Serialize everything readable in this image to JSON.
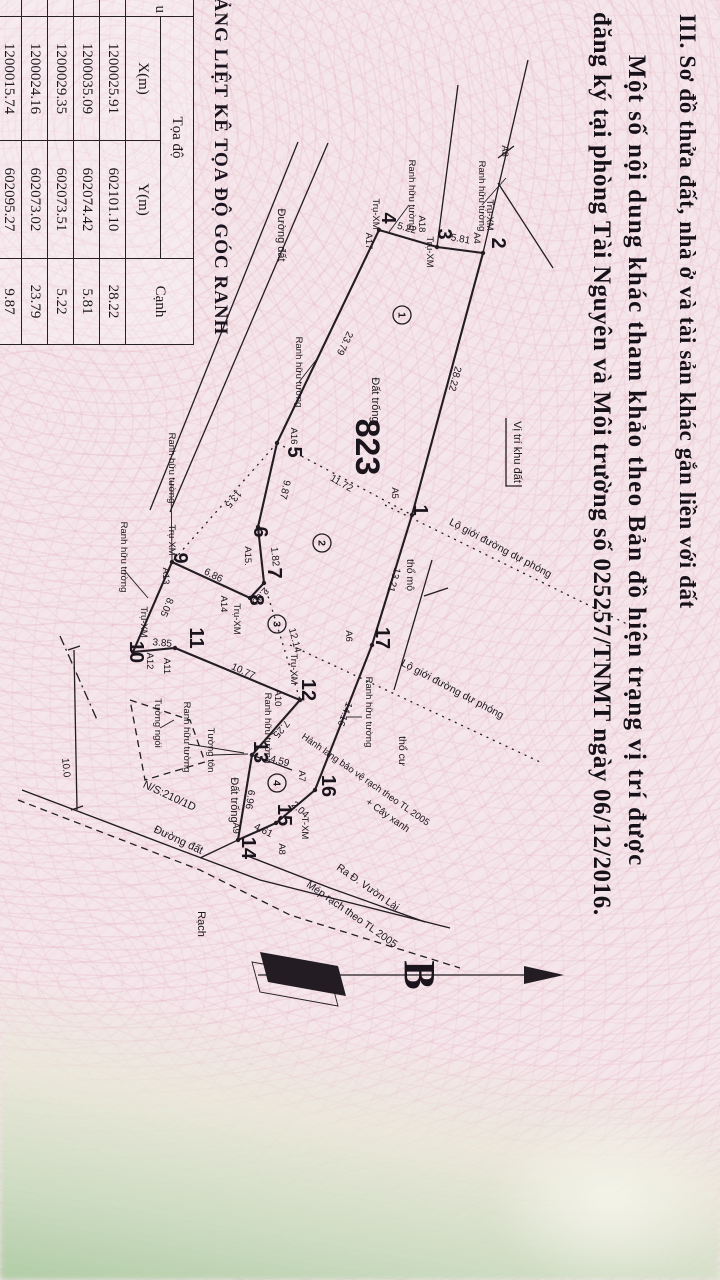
{
  "heading": {
    "line1": "III. Sơ đồ thửa đất, nhà ở và tài sản khác gắn liền với đất",
    "line2": "Một số nội dung khác tham khảo theo Bản đồ hiện trạng vị trí được",
    "line3": "đăng ký tại phòng Tài Nguyên và Môi trường số 025257/TNMT ngày 06/12/2016."
  },
  "compass": {
    "label": "B"
  },
  "table": {
    "title": "BẢNG LIỆT KÊ TỌA ĐỘ GÓC RANH",
    "col_fragment": "u",
    "group_header": "Tọa độ",
    "col_x": "X(m)",
    "col_y": "Y(m)",
    "col_edge": "Cạnh",
    "rows": [
      [
        "1200025.91",
        "602101.10",
        "28.22"
      ],
      [
        "1200035.09",
        "602074.42",
        "5.81"
      ],
      [
        "1200029.35",
        "602073.51",
        "5.22"
      ],
      [
        "1200024.16",
        "602073.02",
        "23.79"
      ],
      [
        "1200015.74",
        "602095.27",
        "9.87"
      ]
    ]
  },
  "map": {
    "plot_number": "823",
    "points": [
      {
        "t": "1",
        "x": 510,
        "y": 306
      },
      {
        "t": "2",
        "x": 243,
        "y": 228
      },
      {
        "t": "3",
        "x": 234,
        "y": 282
      },
      {
        "t": "4",
        "x": 218,
        "y": 338
      },
      {
        "t": "5",
        "x": 452,
        "y": 432
      },
      {
        "t": "6",
        "x": 532,
        "y": 466
      },
      {
        "t": "7",
        "x": 573,
        "y": 452
      },
      {
        "t": "8",
        "x": 600,
        "y": 470
      },
      {
        "t": "9",
        "x": 558,
        "y": 546
      },
      {
        "t": "10",
        "x": 652,
        "y": 590
      },
      {
        "t": "11",
        "x": 638,
        "y": 530
      },
      {
        "t": "12",
        "x": 690,
        "y": 418
      },
      {
        "t": "13",
        "x": 752,
        "y": 466
      },
      {
        "t": "14",
        "x": 848,
        "y": 478
      },
      {
        "t": "15",
        "x": 815,
        "y": 442
      },
      {
        "t": "16",
        "x": 786,
        "y": 398
      },
      {
        "t": "17",
        "x": 638,
        "y": 344
      }
    ],
    "markers": [
      {
        "t": "A3",
        "x": 151,
        "y": 218
      },
      {
        "t": "Trụ-XM",
        "x": 215,
        "y": 233
      },
      {
        "t": "A4",
        "x": 238,
        "y": 246
      },
      {
        "t": "A18",
        "x": 224,
        "y": 301
      },
      {
        "t": "Trụ-XM",
        "x": 252,
        "y": 293
      },
      {
        "t": "Trụ-XM",
        "x": 214,
        "y": 347
      },
      {
        "t": "A17",
        "x": 241,
        "y": 354
      },
      {
        "t": "A16",
        "x": 436,
        "y": 429
      },
      {
        "t": "A5",
        "x": 493,
        "y": 328
      },
      {
        "t": "A6",
        "x": 636,
        "y": 374
      },
      {
        "t": "A15.",
        "x": 556,
        "y": 475
      },
      {
        "t": "Trụ-XM",
        "x": 619,
        "y": 486
      },
      {
        "t": "A14",
        "x": 604,
        "y": 499
      },
      {
        "t": "A13",
        "x": 576,
        "y": 557
      },
      {
        "t": "Trụ-XM",
        "x": 540,
        "y": 551
      },
      {
        "t": "Trụ-XM",
        "x": 622,
        "y": 579
      },
      {
        "t": "A12",
        "x": 661,
        "y": 573
      },
      {
        "t": "A11",
        "x": 666,
        "y": 556
      },
      {
        "t": "A10",
        "x": 698,
        "y": 445
      },
      {
        "t": "Trụ-XM",
        "x": 669,
        "y": 429
      },
      {
        "t": "A9",
        "x": 828,
        "y": 487
      },
      {
        "t": "A8",
        "x": 849,
        "y": 441
      },
      {
        "t": "T-XM",
        "x": 828,
        "y": 418
      },
      {
        "t": "A7",
        "x": 776,
        "y": 421
      }
    ],
    "dimensions": [
      {
        "t": "28.22",
        "x": 378,
        "y": 268,
        "a": 15
      },
      {
        "t": "5.81",
        "x": 242,
        "y": 260,
        "a": -80
      },
      {
        "t": "5.22",
        "x": 231,
        "y": 314,
        "a": -74
      },
      {
        "t": "23.79",
        "x": 342,
        "y": 378,
        "a": 26
      },
      {
        "t": "11.72",
        "x": 486,
        "y": 380,
        "a": -60
      },
      {
        "t": "13.5",
        "x": 497,
        "y": 489,
        "a": 41
      },
      {
        "t": "9.87",
        "x": 489,
        "y": 438,
        "a": 13
      },
      {
        "t": "1.82",
        "x": 557,
        "y": 448,
        "a": -6
      },
      {
        "t": "2.00",
        "x": 594,
        "y": 462,
        "a": 43
      },
      {
        "t": "6.86",
        "x": 578,
        "y": 508,
        "a": -63
      },
      {
        "t": "8.05",
        "x": 606,
        "y": 556,
        "a": 23
      },
      {
        "t": "3.85",
        "x": 646,
        "y": 558,
        "a": -85
      },
      {
        "t": "10.77",
        "x": 674,
        "y": 478,
        "a": -65
      },
      {
        "t": "7.25",
        "x": 727,
        "y": 441,
        "a": 41
      },
      {
        "t": "12.14",
        "x": 641,
        "y": 428,
        "a": -15
      },
      {
        "t": "4.59",
        "x": 764,
        "y": 441,
        "a": -75
      },
      {
        "t": "6.96",
        "x": 799,
        "y": 473,
        "a": 9
      },
      {
        "t": "4.61",
        "x": 833,
        "y": 458,
        "a": -63
      },
      {
        "t": "2.04",
        "x": 812,
        "y": 422,
        "a": -48
      },
      {
        "t": "14.16",
        "x": 713,
        "y": 378,
        "a": 21
      },
      {
        "t": "13.21",
        "x": 579,
        "y": 329,
        "a": 17
      }
    ],
    "labels": [
      {
        "t": "823",
        "x": 447,
        "y": 364,
        "a": 0,
        "s": 34,
        "b": 1,
        "n": "plot-number-label"
      },
      {
        "t": "Đất trống",
        "x": 400,
        "y": 348,
        "a": 0,
        "s": 11
      },
      {
        "t": "Đất trống",
        "x": 800,
        "y": 489,
        "a": 0,
        "s": 11
      },
      {
        "t": "Vị trí khu đất",
        "x": 452,
        "y": 206,
        "a": 0,
        "s": 11
      },
      {
        "t": "Ranh hữu tường",
        "x": 195,
        "y": 311,
        "a": 0,
        "s": 9.5
      },
      {
        "t": "Ranh hữu tường",
        "x": 196,
        "y": 241,
        "a": 0,
        "s": 9.5
      },
      {
        "t": "Ranh hữu tường",
        "x": 372,
        "y": 424,
        "a": 0,
        "s": 9.5
      },
      {
        "t": "Ranh hữu tường",
        "x": 468,
        "y": 551,
        "a": 0,
        "s": 9.5
      },
      {
        "t": "Ranh hữu tường",
        "x": 557,
        "y": 599,
        "a": 0,
        "s": 9.5
      },
      {
        "t": "Ranh hữu tường",
        "x": 728,
        "y": 455,
        "a": 0,
        "s": 9.5
      },
      {
        "t": "Ranh hữu tường",
        "x": 712,
        "y": 354,
        "a": 0,
        "s": 9.5
      },
      {
        "t": "Ranh hữu tường",
        "x": 737,
        "y": 536,
        "a": 0,
        "s": 9.5
      },
      {
        "t": "Tường tôn",
        "x": 750,
        "y": 512,
        "a": 0,
        "s": 9.5
      },
      {
        "t": "Tường ngói",
        "x": 723,
        "y": 565,
        "a": 0,
        "s": 9.5
      },
      {
        "t": "Đường đất",
        "x": 235,
        "y": 442,
        "a": 0,
        "s": 11
      },
      {
        "t": "Đường đất",
        "x": 843,
        "y": 543,
        "a": -65,
        "s": 11
      },
      {
        "t": "N/S:210/1D",
        "x": 799,
        "y": 552,
        "a": -65,
        "s": 11
      },
      {
        "t": "10.0",
        "x": 768,
        "y": 657,
        "a": -6,
        "s": 10
      },
      {
        "t": "Rạch",
        "x": 924,
        "y": 522,
        "a": 0,
        "s": 11
      },
      {
        "t": "Mép rạch theo TL 2005",
        "x": 917,
        "y": 370,
        "a": -55,
        "s": 10.5
      },
      {
        "t": "Ra Đ. Vườn Lài",
        "x": 890,
        "y": 354,
        "a": -55,
        "s": 10.5
      },
      {
        "t": "Hành lang bảo vệ rạch theo TL 2005",
        "x": 782,
        "y": 356,
        "a": -55,
        "s": 9.5
      },
      {
        "t": "+ Cây xanh",
        "x": 818,
        "y": 334,
        "a": -55,
        "s": 10
      },
      {
        "t": "Lộ giới đường dự phóng",
        "x": 551,
        "y": 221,
        "a": -62,
        "s": 10.5
      },
      {
        "t": "Lộ giới đường dự phóng",
        "x": 692,
        "y": 269,
        "a": -62,
        "s": 10.5
      },
      {
        "t": "thổ mộ",
        "x": 575,
        "y": 313,
        "a": 0,
        "s": 10.5
      },
      {
        "t": "thổ cư",
        "x": 751,
        "y": 321,
        "a": 0,
        "s": 10.5
      }
    ],
    "regions": [
      {
        "t": "1",
        "x": 315,
        "y": 318
      },
      {
        "t": "2",
        "x": 543,
        "y": 398
      },
      {
        "t": "3",
        "x": 624,
        "y": 443
      },
      {
        "t": "4",
        "x": 783,
        "y": 443
      }
    ]
  }
}
